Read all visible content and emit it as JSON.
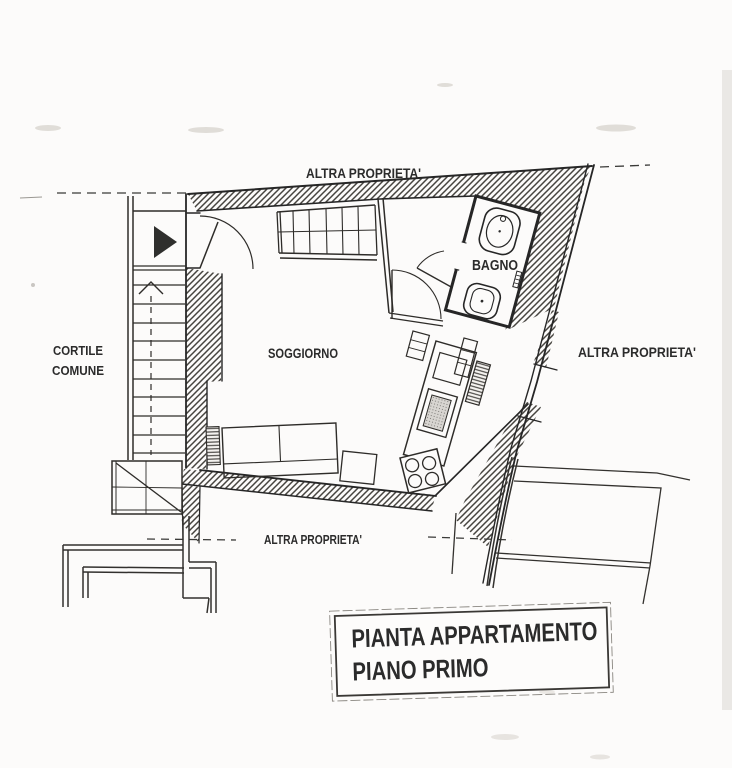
{
  "plan": {
    "labels": {
      "other_property_top": "ALTRA PROPRIETA'",
      "other_property_right": "ALTRA PROPRIETA'",
      "other_property_bottom": "ALTRA PROPRIETA'",
      "courtyard_line1": "CORTILE",
      "courtyard_line2": "COMUNE",
      "living_room": "SOGGIORNO",
      "bathroom": "BAGNO"
    },
    "title_box": {
      "line1": "PIANTA APPARTAMENTO",
      "line2": "PIANO PRIMO"
    },
    "colors": {
      "paper": "#fcfbfa",
      "ink": "#2b2b2b",
      "hatch": "#45433f"
    }
  }
}
